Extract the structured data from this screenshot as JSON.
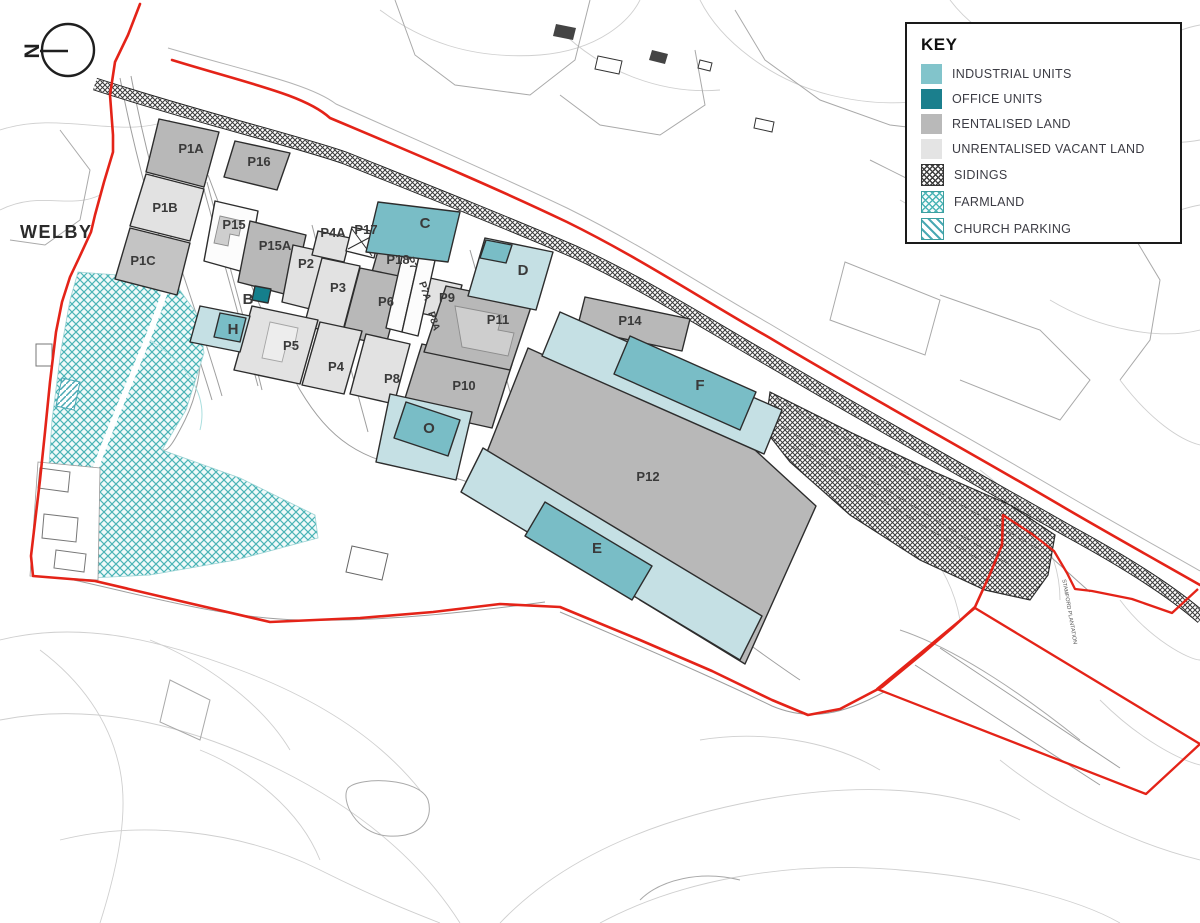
{
  "area_label": "WELBY",
  "north_label": "N",
  "key": {
    "title": "KEY",
    "items": [
      {
        "label": "INDUSTRIAL UNITS",
        "swatch": "industrial-units-swatch"
      },
      {
        "label": "OFFICE UNITS",
        "swatch": "office-units-swatch"
      },
      {
        "label": "RENTALISED LAND",
        "swatch": "rentalised-land-swatch"
      },
      {
        "label": "UNRENTALISED VACANT LAND",
        "swatch": "unrentalised-vacant-land-swatch"
      },
      {
        "label": "SIDINGS",
        "swatch": "sidings-swatch"
      },
      {
        "label": "FARMLAND",
        "swatch": "farmland-swatch"
      },
      {
        "label": "CHURCH PARKING",
        "swatch": "church-parking-swatch"
      }
    ]
  },
  "labels": {
    "p1a": "P1A",
    "p1b": "P1B",
    "p1c": "P1C",
    "p16": "P16",
    "p15": "P15",
    "p15a": "P15A",
    "p2": "P2",
    "p3": "P3",
    "p4": "P4",
    "p4a": "P4A",
    "p5": "P5",
    "p6": "P6",
    "p7": "P7",
    "p7a": "P7A",
    "p8": "P8",
    "p8a": "P8A",
    "p9": "P9",
    "p10": "P10",
    "p11": "P11",
    "p12": "P12",
    "p14": "P14",
    "p17": "P17",
    "p18": "P18",
    "b": "B",
    "c": "C",
    "d": "D",
    "e": "E",
    "f": "F",
    "h": "H",
    "o": "O",
    "stamford": "STAMFORD PLANTATION"
  },
  "colors": {
    "industrial_units": "#82c4cb",
    "industrial_parcel_light": "#c5e0e4",
    "office_units": "#1b7f8d",
    "rentalised_land": "#b9b9b9",
    "unrentalised_vacant_land": "#e4e4e4",
    "sidings_hatch": "#3f3f3f",
    "farmland_hatch": "#4ab4b6",
    "church_parking_hatch": "#4aa9b4",
    "boundary_red": "#e42318",
    "plot_outline": "#2d2d2d",
    "contour_gray": "#cfcfcf"
  }
}
